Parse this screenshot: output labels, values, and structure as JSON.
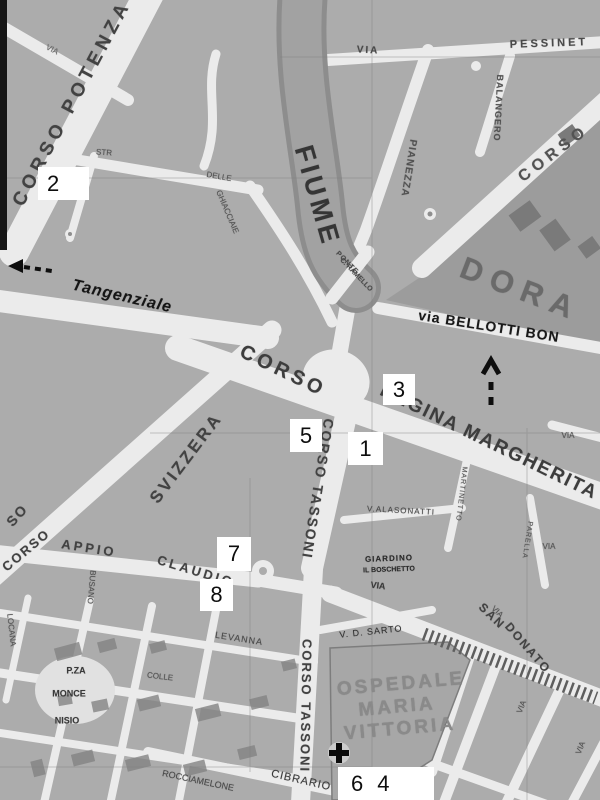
{
  "map": {
    "description": "Scanned grayscale street map of a city district (Turin area: Dora river, Corso Tassoni, Corso Regina Margherita, Ospedale Maria Vittoria) with numbered white overlay markers",
    "colors": {
      "paper_street": "#e9e8e3",
      "block": "#acaba6",
      "river": "#8e8d88",
      "river_fill": "#a3a19c",
      "dark_zone": "#9c9b96",
      "building": "#7b7a75",
      "ink": "#3b3b38",
      "marker_bg": "#ffffff",
      "marker_text": "#0d0d0d",
      "edge_bar": "#191918"
    },
    "labels": [
      {
        "id": "corso-potenza",
        "text": "CORSO POTENZA",
        "x": 72,
        "y": 103,
        "r": -62,
        "s": 19,
        "w": 700,
        "ls": 5,
        "c": "#45443f"
      },
      {
        "id": "via-topleft",
        "text": "VIA",
        "x": 52,
        "y": 50,
        "r": 27,
        "s": 8,
        "w": 400,
        "c": "#6a6963"
      },
      {
        "id": "fiume",
        "text": "FIUME",
        "x": 317,
        "y": 196,
        "r": 74,
        "s": 27,
        "w": 700,
        "ls": 4,
        "c": "#38382f"
      },
      {
        "id": "dora",
        "text": "DORA",
        "x": 521,
        "y": 289,
        "r": 21,
        "s": 31,
        "w": 700,
        "ls": 9,
        "c": "#6c6b66"
      },
      {
        "id": "corso-top-right",
        "text": "CORSO",
        "x": 554,
        "y": 154,
        "r": -37,
        "s": 16,
        "w": 700,
        "ls": 5,
        "c": "#56554f"
      },
      {
        "id": "via-pessinetto-via",
        "text": "VIA",
        "x": 368,
        "y": 51,
        "r": 3,
        "s": 10,
        "w": 700,
        "ls": 2,
        "c": "#4c4b46"
      },
      {
        "id": "via-pessinetto",
        "text": "PESSINET",
        "x": 549,
        "y": 44,
        "r": -2,
        "s": 11,
        "w": 700,
        "ls": 3,
        "c": "#4c4b46"
      },
      {
        "id": "via-pianezza",
        "text": "PIANEZZA",
        "x": 408,
        "y": 168,
        "r": 99,
        "s": 10,
        "w": 700,
        "ls": 1,
        "c": "#55544e"
      },
      {
        "id": "via-balangero",
        "text": "BALANGERO",
        "x": 498,
        "y": 108,
        "r": 93,
        "s": 9,
        "w": 700,
        "ls": 1,
        "c": "#55544e"
      },
      {
        "id": "ponte-line1",
        "text": "PONTE",
        "x": 347,
        "y": 263,
        "r": 46,
        "s": 7,
        "w": 700,
        "ls": 1,
        "c": "#4c4b46"
      },
      {
        "id": "ponte-line2",
        "text": "C. RAMELLO",
        "x": 356,
        "y": 275,
        "r": 46,
        "s": 7,
        "w": 700,
        "ls": 0,
        "c": "#4c4b46"
      },
      {
        "id": "via-bellotti-bon",
        "text": "via BELLOTTI BON",
        "x": 489,
        "y": 326,
        "r": 9,
        "s": 14,
        "w": 700,
        "ls": 1,
        "c": "#1c1c19"
      },
      {
        "id": "tangenziale",
        "text": "Tangenziale",
        "x": 122,
        "y": 297,
        "r": 13,
        "s": 16,
        "w": 700,
        "ls": 1,
        "c": "#181815",
        "i": 1
      },
      {
        "id": "corso-regina-corso",
        "text": "CORSO",
        "x": 283,
        "y": 371,
        "r": 26,
        "s": 20,
        "w": 700,
        "ls": 4,
        "c": "#403f3a"
      },
      {
        "id": "regina-margherita",
        "text": "REGINA MARGHERITA",
        "x": 489,
        "y": 442,
        "r": 26,
        "s": 19,
        "w": 700,
        "ls": 2,
        "c": "#403f3a"
      },
      {
        "id": "corso-svizzera",
        "text": "SVIZZERA",
        "x": 186,
        "y": 458,
        "r": -53,
        "s": 17,
        "w": 700,
        "ls": 3,
        "c": "#45443f"
      },
      {
        "id": "corso-tassoni-upper",
        "text": "CORSO TASSONI",
        "x": 318,
        "y": 489,
        "r": 99,
        "s": 14,
        "w": 700,
        "ls": 2,
        "c": "#45443f"
      },
      {
        "id": "corso-tassoni-lower",
        "text": "CORSO TASSONI",
        "x": 306,
        "y": 706,
        "r": 91,
        "s": 13,
        "w": 700,
        "ls": 2,
        "c": "#45443f"
      },
      {
        "id": "corso-frag-so",
        "text": "SO",
        "x": 17,
        "y": 515,
        "r": -48,
        "s": 14,
        "w": 700,
        "ls": 2,
        "c": "#45443f"
      },
      {
        "id": "corso-appio-corso",
        "text": "CORSO",
        "x": 26,
        "y": 550,
        "r": -40,
        "s": 13,
        "w": 700,
        "ls": 2,
        "c": "#45443f"
      },
      {
        "id": "appio",
        "text": "APPIO",
        "x": 89,
        "y": 548,
        "r": 9,
        "s": 13,
        "w": 700,
        "ls": 3,
        "c": "#45443f"
      },
      {
        "id": "claudio",
        "text": "CLAUDIO",
        "x": 196,
        "y": 571,
        "r": 17,
        "s": 13,
        "w": 700,
        "ls": 3,
        "c": "#45443f"
      },
      {
        "id": "san",
        "text": "SAN",
        "x": 492,
        "y": 616,
        "r": 44,
        "s": 12,
        "w": 700,
        "ls": 2,
        "c": "#45443f"
      },
      {
        "id": "donato",
        "text": "DONATO",
        "x": 528,
        "y": 648,
        "r": 49,
        "s": 12,
        "w": 700,
        "ls": 2,
        "c": "#45443f"
      },
      {
        "id": "via-alasonatti",
        "text": "V.ALASONATTI",
        "x": 401,
        "y": 511,
        "r": 3,
        "s": 8,
        "w": 400,
        "ls": 1,
        "c": "#4c4b46"
      },
      {
        "id": "martinetto",
        "text": "MARTINETTO",
        "x": 461,
        "y": 494,
        "r": 97,
        "s": 7,
        "w": 400,
        "ls": 1,
        "c": "#55544e"
      },
      {
        "id": "parella",
        "text": "PARELLA",
        "x": 527,
        "y": 540,
        "r": 99,
        "s": 7,
        "w": 400,
        "ls": 1,
        "c": "#55544e"
      },
      {
        "id": "giardino-line1",
        "text": "GIARDINO",
        "x": 389,
        "y": 559,
        "r": -2,
        "s": 8,
        "w": 700,
        "ls": 1,
        "c": "#2b2b27"
      },
      {
        "id": "giardino-line2",
        "text": "IL BOSCHETTO",
        "x": 389,
        "y": 570,
        "r": -2,
        "s": 7,
        "w": 700,
        "ls": 0,
        "c": "#2b2b27"
      },
      {
        "id": "via-d-sarto",
        "text": "V. D. SARTO",
        "x": 371,
        "y": 632,
        "r": -6,
        "s": 9,
        "w": 400,
        "ls": 1,
        "c": "#333330"
      },
      {
        "id": "ospedale-line1",
        "text": "OSPEDALE",
        "x": 401,
        "y": 684,
        "r": -5,
        "s": 19,
        "w": 700,
        "ls": 3,
        "c": "#8b8a85"
      },
      {
        "id": "ospedale-line2",
        "text": "MARIA",
        "x": 397,
        "y": 707,
        "r": -5,
        "s": 19,
        "w": 700,
        "ls": 3,
        "c": "#8b8a85"
      },
      {
        "id": "ospedale-line3",
        "text": "VITTORIA",
        "x": 400,
        "y": 729,
        "r": -5,
        "s": 19,
        "w": 700,
        "ls": 3,
        "c": "#8b8a85"
      },
      {
        "id": "via-levanna",
        "text": "LEVANNA",
        "x": 239,
        "y": 639,
        "r": 9,
        "s": 9,
        "w": 400,
        "ls": 1,
        "c": "#4c4b46"
      },
      {
        "id": "pza",
        "text": "P.ZA",
        "x": 76,
        "y": 671,
        "r": 0,
        "s": 9,
        "w": 700,
        "c": "#3c3b37"
      },
      {
        "id": "monce",
        "text": "MONCE",
        "x": 69,
        "y": 694,
        "r": 0,
        "s": 9,
        "w": 700,
        "c": "#3c3b37"
      },
      {
        "id": "nisio",
        "text": "NISIO",
        "x": 67,
        "y": 721,
        "r": 0,
        "s": 9,
        "w": 700,
        "c": "#3c3b37"
      },
      {
        "id": "colle",
        "text": "COLLE",
        "x": 160,
        "y": 677,
        "r": 7,
        "s": 8,
        "w": 400,
        "c": "#55544e"
      },
      {
        "id": "via-rocciamelone",
        "text": "ROCCIAMELONE",
        "x": 198,
        "y": 781,
        "r": 12,
        "s": 9,
        "w": 400,
        "c": "#4c4b46"
      },
      {
        "id": "via-cibrario",
        "text": "CIBRARIO",
        "x": 301,
        "y": 781,
        "r": 13,
        "s": 11,
        "w": 400,
        "ls": 1,
        "c": "#3a3a35"
      },
      {
        "id": "locana",
        "text": "LOCANA",
        "x": 11,
        "y": 630,
        "r": 84,
        "s": 8,
        "w": 400,
        "c": "#55544e"
      },
      {
        "id": "busano",
        "text": "BUSANO",
        "x": 91,
        "y": 587,
        "r": 95,
        "s": 8,
        "w": 400,
        "c": "#55544e"
      },
      {
        "id": "str",
        "text": "STR",
        "x": 104,
        "y": 153,
        "r": 4,
        "s": 8,
        "w": 400,
        "c": "#55544e"
      },
      {
        "id": "delle",
        "text": "DELLE",
        "x": 219,
        "y": 177,
        "r": 10,
        "s": 8,
        "w": 400,
        "c": "#55544e"
      },
      {
        "id": "ghiacciaie",
        "text": "GHIACCIAIE",
        "x": 227,
        "y": 212,
        "r": 67,
        "s": 8,
        "w": 400,
        "c": "#55544e"
      },
      {
        "id": "via-1",
        "text": "VIA",
        "x": 568,
        "y": 436,
        "r": 0,
        "s": 8,
        "w": 400,
        "c": "#55544e"
      },
      {
        "id": "via-2",
        "text": "VIA",
        "x": 549,
        "y": 547,
        "r": 0,
        "s": 8,
        "w": 400,
        "c": "#55544e"
      },
      {
        "id": "via-3",
        "text": "VIA",
        "x": 378,
        "y": 586,
        "r": 7,
        "s": 9,
        "w": 700,
        "c": "#3c3b37"
      },
      {
        "id": "via-4",
        "text": "VIA",
        "x": 522,
        "y": 707,
        "r": -68,
        "s": 8,
        "w": 400,
        "c": "#55544e"
      },
      {
        "id": "via-5",
        "text": "VIA",
        "x": 581,
        "y": 748,
        "r": -68,
        "s": 8,
        "w": 400,
        "c": "#55544e"
      },
      {
        "id": "via-6",
        "text": "VIA",
        "x": 497,
        "y": 612,
        "r": 44,
        "s": 8,
        "w": 400,
        "c": "#55544e"
      }
    ],
    "markers": [
      {
        "label": "2",
        "x": 38,
        "y": 167,
        "w": 42,
        "h": 33,
        "pl": 9
      },
      {
        "label": "3",
        "x": 383,
        "y": 374,
        "w": 32,
        "h": 31
      },
      {
        "label": "5",
        "x": 290,
        "y": 419,
        "w": 32,
        "h": 33
      },
      {
        "label": "1",
        "x": 348,
        "y": 432,
        "w": 35,
        "h": 33
      },
      {
        "label": "7",
        "x": 217,
        "y": 537,
        "w": 34,
        "h": 34
      },
      {
        "label": "8",
        "x": 200,
        "y": 579,
        "w": 33,
        "h": 32
      },
      {
        "label": "6 4",
        "x": 338,
        "y": 767,
        "w": 83,
        "h": 33,
        "pl": 13,
        "gap": 14
      }
    ],
    "icons": [
      {
        "name": "hospital-cross-icon",
        "meaning": "hospital (Ospedale Maria Vittoria)"
      },
      {
        "name": "tangenziale-arrow-icon",
        "meaning": "dashed arrow pointing left toward Tangenziale"
      },
      {
        "name": "route-arrow-up-icon",
        "meaning": "dashed arrow pointing up near via Bellotti Bon"
      }
    ]
  }
}
